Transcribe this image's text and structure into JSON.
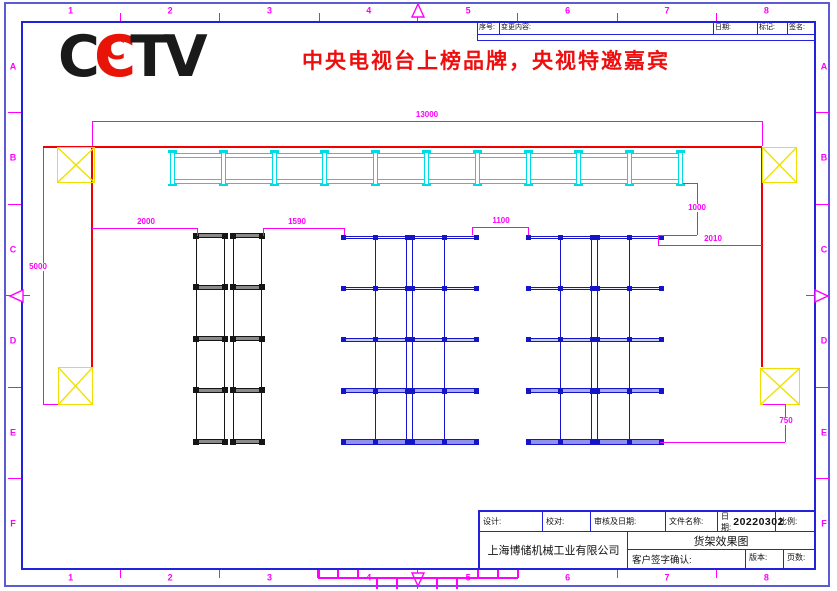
{
  "sheet": {
    "zone_numbers": [
      "1",
      "2",
      "3",
      "4",
      "5",
      "6",
      "7",
      "8"
    ],
    "zone_letters": [
      "A",
      "B",
      "C",
      "D",
      "E",
      "F"
    ]
  },
  "logo": {
    "name": "CCTV",
    "letters": [
      {
        "ch": "C",
        "color": "#1a1a1a",
        "nested": false
      },
      {
        "ch": "C",
        "color": "#e81407",
        "nested": true
      },
      {
        "ch": "T",
        "color": "#1a1a1a",
        "nested": false
      },
      {
        "ch": "V",
        "color": "#1a1a1a",
        "nested": false
      }
    ]
  },
  "headline": {
    "text": "中央电视台上榜品牌，央视特邀嘉宾",
    "color": "#ee0e0e"
  },
  "revision_table": {
    "y": 21,
    "h": 20,
    "mid_y": 34,
    "columns": [
      {
        "label": "序号:",
        "x": 477,
        "w": 22
      },
      {
        "label": "变更内容:",
        "x": 499,
        "w": 214
      },
      {
        "label": "日期:",
        "x": 713,
        "w": 44
      },
      {
        "label": "标记:",
        "x": 757,
        "w": 30
      },
      {
        "label": "签名:",
        "x": 787,
        "w": 29
      }
    ]
  },
  "colors": {
    "magenta": "#ff00ff",
    "red": "#f00000",
    "yellow": "#f0e000",
    "cyan": "#00dce6",
    "blue": "#1414c8",
    "black": "#151515",
    "frame": "#2222dd",
    "outer": "#5b5bd6"
  },
  "drawing": {
    "red_lines": [
      [
        43,
        147,
        762,
        147
      ],
      [
        92,
        147,
        92,
        367
      ],
      [
        762,
        147,
        762,
        367
      ]
    ],
    "columns": [
      {
        "x": 57,
        "y": 147,
        "w": 38,
        "h": 36
      },
      {
        "x": 762,
        "y": 147,
        "w": 35,
        "h": 36
      },
      {
        "x": 58,
        "y": 367,
        "w": 35,
        "h": 38
      },
      {
        "x": 760,
        "y": 368,
        "w": 40,
        "h": 37
      }
    ],
    "cyan_rack": {
      "x": 170,
      "y": 151,
      "w": 513,
      "h": 34,
      "uprights": 11
    },
    "black_rack_spec": {
      "y": 233,
      "w": 30,
      "h": 211,
      "levels": 5
    },
    "black_racks": [
      {
        "x": 195
      },
      {
        "x": 232
      }
    ],
    "blue_rack_spec": {
      "y": 236,
      "w": 64,
      "h": 209,
      "levels": 5
    },
    "blue_racks": [
      {
        "x": 343,
        "up": "mr"
      },
      {
        "x": 412,
        "up": "lm"
      },
      {
        "x": 528,
        "up": "mr"
      },
      {
        "x": 597,
        "up": "lm"
      }
    ],
    "dimensions": [
      {
        "label": "13000",
        "lines": [
          [
            92,
            121,
            762,
            121
          ],
          [
            92,
            121,
            92,
            146
          ],
          [
            762,
            121,
            762,
            146
          ]
        ],
        "label_pos": [
          427,
          115
        ],
        "bg": false
      },
      {
        "label": "5000",
        "lines": [
          [
            43,
            148,
            43,
            404
          ],
          [
            43,
            404,
            58,
            404
          ]
        ],
        "label_pos": [
          38,
          267
        ],
        "bg": true
      },
      {
        "label": "2000",
        "lines": [
          [
            92,
            228,
            197,
            228
          ],
          [
            197,
            228,
            197,
            236
          ]
        ],
        "label_pos": [
          146,
          222
        ],
        "bg": false
      },
      {
        "label": "1590",
        "lines": [
          [
            263,
            228,
            344,
            228
          ],
          [
            263,
            228,
            263,
            236
          ],
          [
            344,
            228,
            344,
            235
          ]
        ],
        "label_pos": [
          297,
          222
        ],
        "bg": false
      },
      {
        "label": "1100",
        "lines": [
          [
            472,
            227,
            528,
            227
          ],
          [
            472,
            227,
            472,
            235
          ],
          [
            528,
            227,
            528,
            235
          ]
        ],
        "label_pos": [
          501,
          221
        ],
        "bg": false
      },
      {
        "label": "1000",
        "lines": [
          [
            697,
            183,
            697,
            235
          ],
          [
            683,
            183,
            697,
            183
          ],
          [
            658,
            235,
            697,
            235
          ],
          [
            658,
            235,
            658,
            245
          ]
        ],
        "label_pos": [
          697,
          208
        ],
        "bg": true
      },
      {
        "label": "2010",
        "lines": [
          [
            658,
            245,
            762,
            245
          ]
        ],
        "label_pos": [
          713,
          239
        ],
        "bg": false
      },
      {
        "label": "750",
        "lines": [
          [
            785,
            404,
            785,
            442
          ],
          [
            763,
            404,
            785,
            404
          ],
          [
            660,
            442,
            785,
            442
          ]
        ],
        "label_pos": [
          786,
          421
        ],
        "bg": true
      }
    ]
  },
  "title_block": {
    "design_label": "设计:",
    "proof_label": "校对:",
    "review_label": "审核及日期:",
    "filename_label": "文件名称:",
    "date_label": "日期:",
    "date_value": "20220302",
    "scale_label": "比例:",
    "company": "上海博储机械工业有限公司",
    "drawing_title": "货架效果图",
    "customer_sign_label": "客户签字确认:",
    "version_label": "版本:",
    "pages_label": "页数:"
  }
}
